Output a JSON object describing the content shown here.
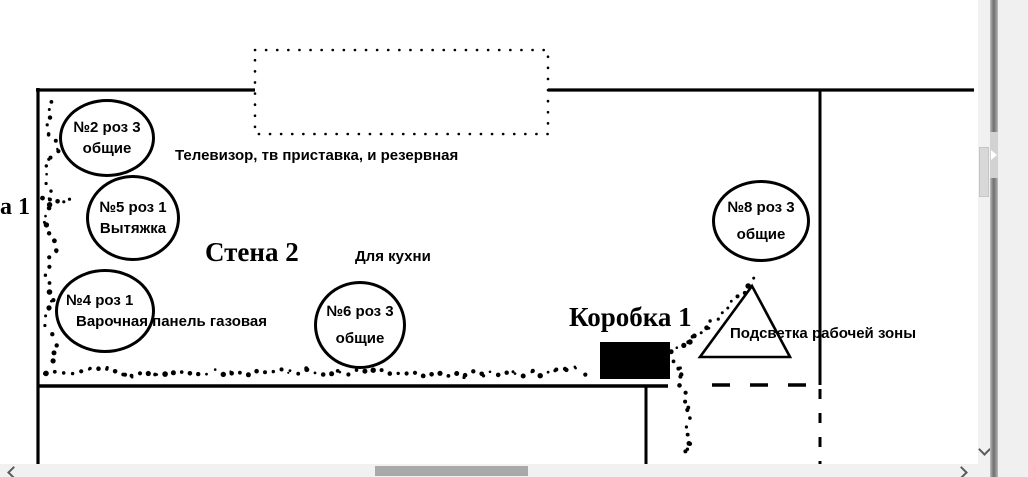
{
  "diagram": {
    "left_wall_label": "а 1",
    "top_note": "Телевизор, тв приставка, и резервная",
    "wall_title": "Стена 2",
    "kitchen_note": "Для кухни",
    "junction_box_label": "Коробка 1",
    "worklight_label": "Подсветка рабочей зоны",
    "outlets": [
      {
        "line1": "№2 роз 3",
        "line2": "общие"
      },
      {
        "line1": "№5 роз 1",
        "line2": "Вытяжка"
      },
      {
        "line1": "№4 роз 1",
        "line2": "Варочная панель газовая"
      },
      {
        "line1": "№6 роз 3",
        "line2": "общие"
      },
      {
        "line1": "№8 роз 3",
        "line2": "общие"
      }
    ]
  },
  "colors": {
    "line": "#000000",
    "scroll_track": "#f1f1f1",
    "h_thumb": "#a9a9a9",
    "v_thumb": "#d8d8d8",
    "splitter": "#6f6f6f",
    "background": "#ffffff"
  }
}
